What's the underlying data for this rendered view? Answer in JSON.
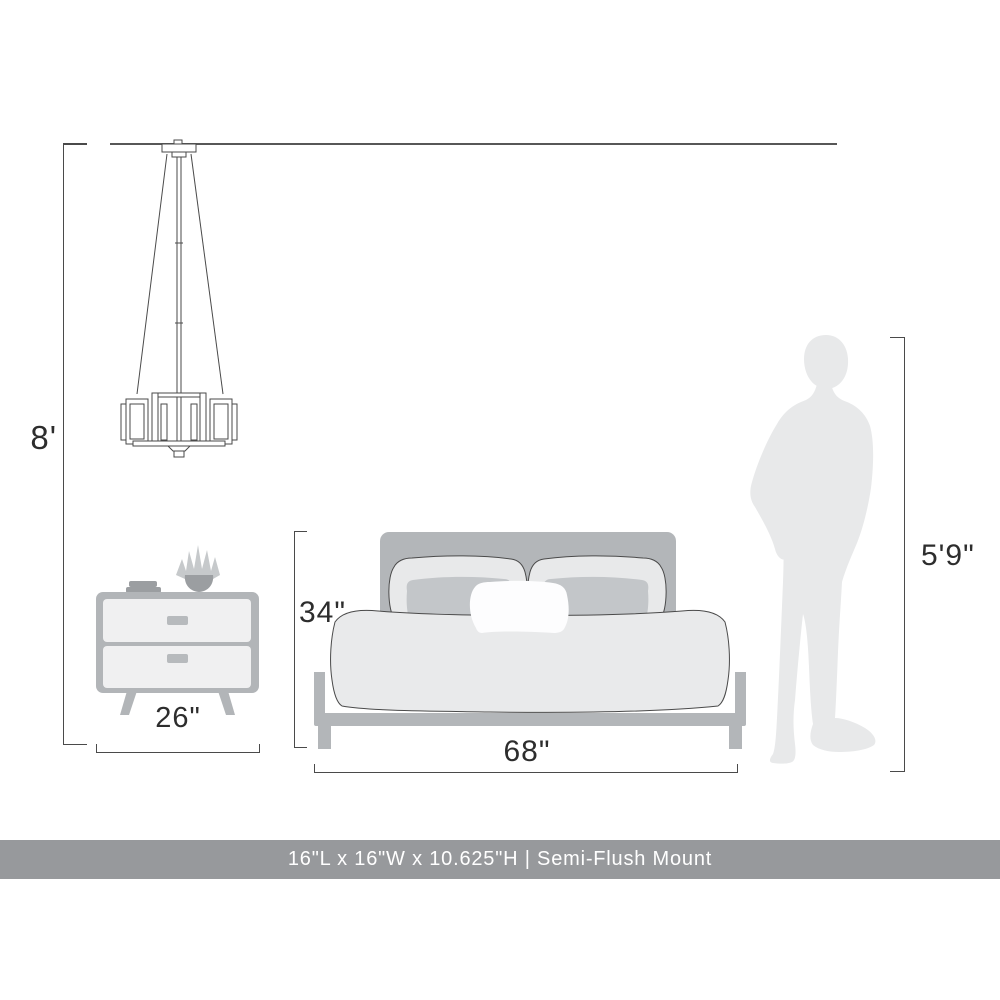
{
  "canvas": {
    "width": 1000,
    "height": 1000,
    "background": "#ffffff"
  },
  "dimensions": {
    "ceiling_height": "8'",
    "nightstand_width": "26\"",
    "bed_height": "34\"",
    "bed_width": "68\"",
    "person_height": "5'9\""
  },
  "banner": {
    "text": "16\"L x 16\"W x 10.625\"H | Semi-Flush Mount"
  },
  "figures": {
    "light": "semi-flush-mount-pendant-light",
    "nightstand": "two-drawer-nightstand-with-books-and-plant",
    "bed": "bed-front-view-with-pillows",
    "person": "standing-person-silhouette"
  },
  "colors": {
    "line": "#4a4a4a",
    "ceiling_line": "#575757",
    "label_text": "#2d2d2d",
    "furniture_gray": "#b3b6b9",
    "soft_gray": "#e8e9ea",
    "accent_gray": "#c3c6c9",
    "drawer_face": "#f0f0f1",
    "object_gray": "#9b9ea1",
    "white_pillow": "#fdfdfe",
    "banner_bg": "#97999c",
    "banner_text": "#ffffff"
  }
}
